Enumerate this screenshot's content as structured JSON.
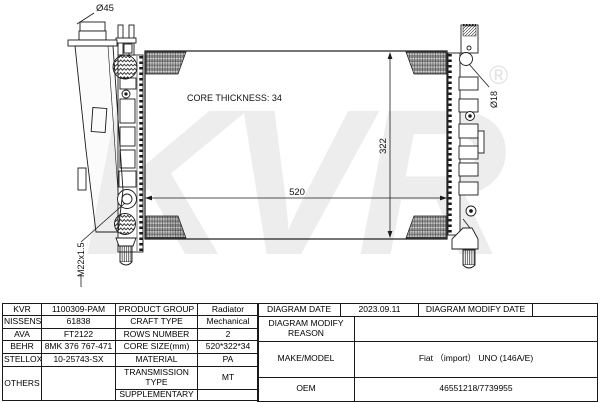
{
  "diagram": {
    "labels": {
      "filler_diameter": "Ø45",
      "core_thickness": "CORE THICKNESS: 34",
      "core_height": "322",
      "core_width": "520",
      "outlet_diameter": "Ø18",
      "drain_thread": "M22x1.5"
    },
    "watermark": {
      "text": "KVR",
      "registered": "®",
      "color": "#ededed"
    },
    "line_color": "#1a1a1a"
  },
  "spec_table": {
    "rows": [
      {
        "brand": "KVR",
        "code": "1100309-PAM",
        "prop": "PRODUCT GROUP",
        "val": "Radiator"
      },
      {
        "brand": "NISSENS",
        "code": "61838",
        "prop": "CRAFT TYPE",
        "val": "Mechanical"
      },
      {
        "brand": "AVA",
        "code": "FT2122",
        "prop": "ROWS NUMBER",
        "val": "2"
      },
      {
        "brand": "BEHR",
        "code": "8MK 376 767-471",
        "prop": "CORE SIZE(mm)",
        "val": "520*322*34"
      },
      {
        "brand": "STELLOX",
        "code": "10-25743-SX",
        "prop": "MATERIAL",
        "val": "PA"
      },
      {
        "brand": "OTHERS",
        "code": "",
        "prop": "TRANSMISSION TYPE",
        "val": "MT"
      },
      {
        "brand": "",
        "code": "",
        "prop": "SUPPLEMENTARY",
        "val": ""
      }
    ]
  },
  "info_table": {
    "diagram_date_label": "DIAGRAM DATE",
    "diagram_date": "2023.09.11",
    "modify_date_label": "DIAGRAM MODIFY DATE",
    "modify_date": "",
    "modify_reason_label": "DIAGRAM MODIFY REASON",
    "modify_reason": "",
    "make_model_label": "MAKE/MODEL",
    "make_model": "Fiat （import） UNO (146A/E)",
    "oem_label": "OEM",
    "oem": "46551218/7739955"
  }
}
